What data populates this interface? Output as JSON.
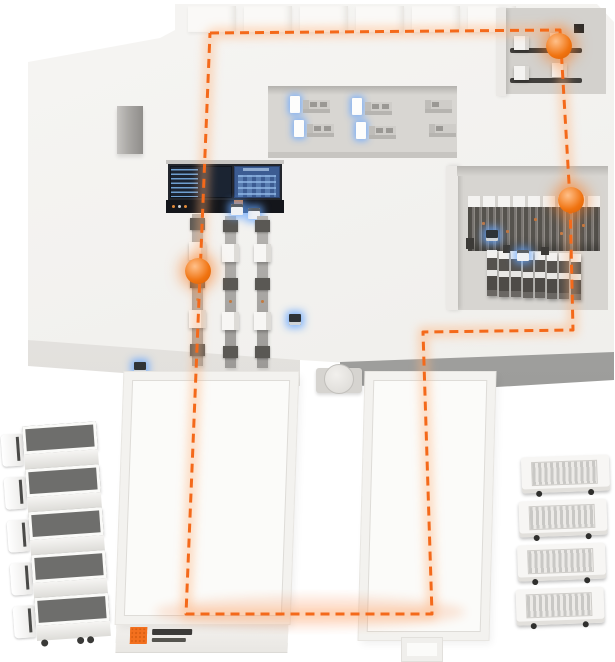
{
  "scene": {
    "type": "isometric-warehouse-logistics-diagram",
    "background_color": "#ffffff",
    "floor_color": "#f2f1ee",
    "accent_color": "#f3701e"
  },
  "route_path": {
    "color": "#f4691a",
    "glow_color": "#ffb27a",
    "dash": "9 6",
    "points": [
      [
        210,
        33
      ],
      [
        560,
        30
      ],
      [
        570,
        200
      ],
      [
        573,
        330
      ],
      [
        423,
        332
      ],
      [
        432,
        614
      ],
      [
        186,
        614
      ],
      [
        210,
        33
      ]
    ],
    "markers": [
      {
        "name": "inbound-node",
        "x": 559,
        "y": 46
      },
      {
        "name": "rack-node",
        "x": 571,
        "y": 200
      },
      {
        "name": "conveyor-node",
        "x": 198,
        "y": 271
      }
    ]
  },
  "zones": {
    "control_dashboard": {
      "screens": 2,
      "left_screen_color": "#1b2432",
      "right_screen_color": "#3c5c92"
    },
    "workstation_corridor": {
      "stations": 6
    },
    "inbound_room": {
      "machines": 4
    },
    "rack_room": {
      "top_rack_rows": 1,
      "bottom_rack_units": 8
    },
    "conveyor_area": {
      "lines": 3
    },
    "roof": {
      "skylights": 6
    },
    "docks": {
      "left": 1,
      "right": 1,
      "turntable": 1
    }
  },
  "vehicles": {
    "left_trucks": 5,
    "right_trucks": 4
  },
  "indicators": {
    "blue_glow_devices": 7
  },
  "logo": {
    "square_color": "#f3701e"
  }
}
